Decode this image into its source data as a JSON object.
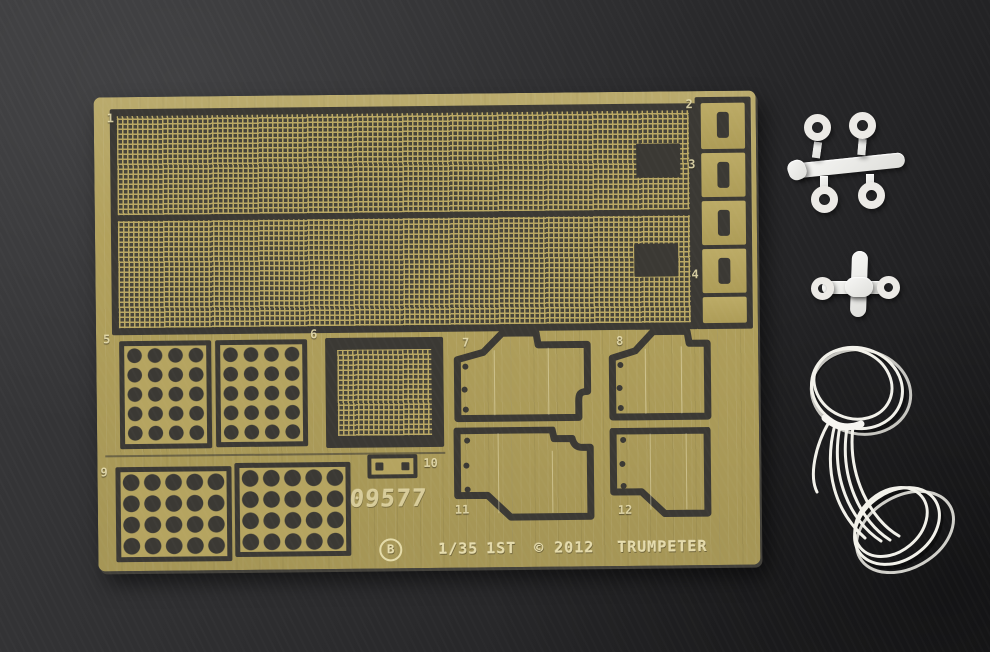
{
  "fret": {
    "code": "09577",
    "letter_badge": "B",
    "scale": "1/35",
    "variant": "1ST",
    "copyright": "© 2012",
    "brand": "TRUMPETER",
    "labels": [
      "1",
      "2",
      "3",
      "4",
      "5",
      "6",
      "7",
      "8",
      "9",
      "10",
      "11",
      "12"
    ]
  },
  "colors": {
    "background": "#2e2e30",
    "brass": "#b2a15c",
    "etch_dark": "#3b3934",
    "etched_text": "#e8dfae",
    "plastic": "#ebebe9",
    "string": "#f2f1ea"
  }
}
